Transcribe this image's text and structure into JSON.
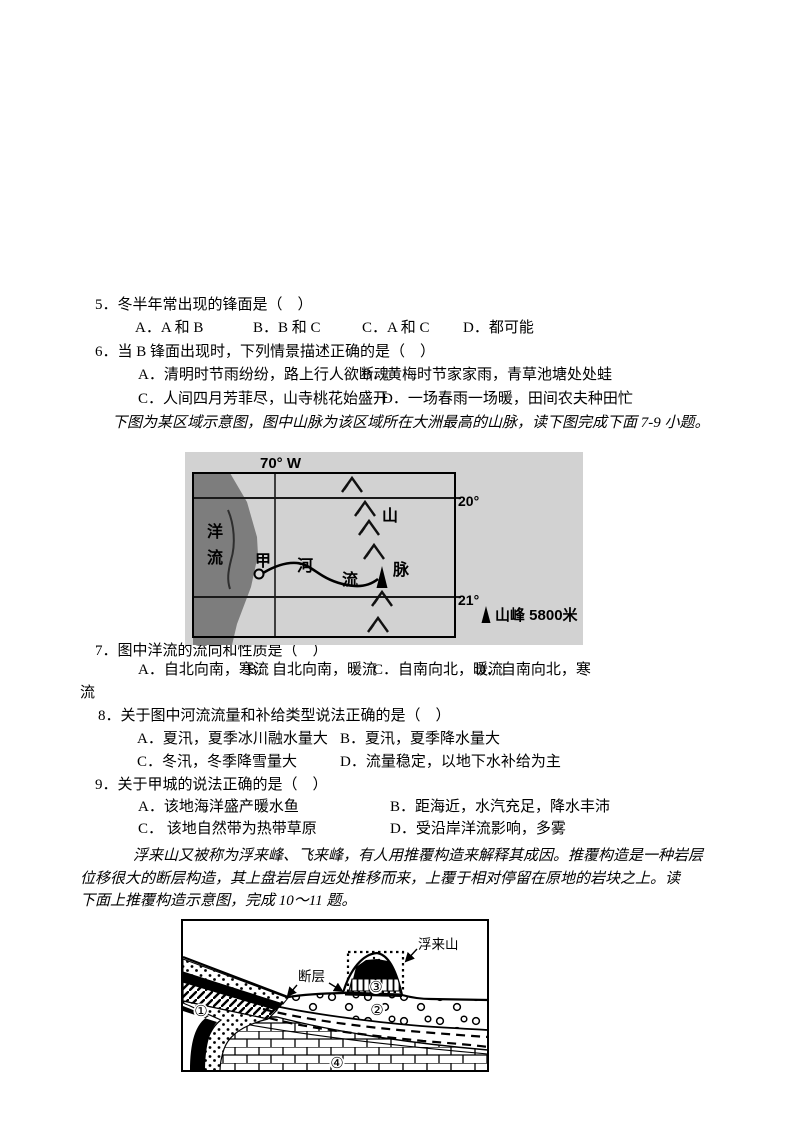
{
  "q5": {
    "stem": "5．冬半年常出现的锋面是（　）",
    "opt_a": "A．A 和 B",
    "opt_b": "B．B 和 C",
    "opt_c": "C．A 和 C",
    "opt_d": "D．都可能"
  },
  "q6": {
    "stem": "6．当 B 锋面出现时，下列情景描述正确的是（　）",
    "opt_a": "A．清明时节雨纷纷，路上行人欲断魂",
    "opt_b": "B．黄梅时节家家雨，青草池塘处处蛙",
    "opt_c": "C．人间四月芳菲尽，山寺桃花始盛开",
    "opt_d": "D．一场春雨一场暖，田间农夫种田忙"
  },
  "intro_7_9": "下图为某区域示意图，图中山脉为该区域所在大洲最高的山脉，读下图完成下面 7-9 小题。",
  "q7": {
    "stem": "7．图中洋流的流向和性质是（　）",
    "opt_a": "A．自北向南，寒流",
    "opt_b": "B．自北向南，暖流",
    "opt_c": "C．自南向北，暖流",
    "opt_d": "D．自南向北，寒",
    "wrap": "流"
  },
  "q8": {
    "stem": "8．关于图中河流流量和补给类型说法正确的是（　）",
    "opt_a": "A．夏汛，夏季冰川融水量大",
    "opt_b": "B．夏汛，夏季降水量大",
    "opt_c": "C．冬汛，冬季降雪量大",
    "opt_d": "D．流量稳定，以地下水补给为主"
  },
  "q9": {
    "stem": "9．关于甲城的说法正确的是（　）",
    "opt_a": "A．该地海洋盛产暖水鱼",
    "opt_b": "B．距海近，水汽充足，降水丰沛",
    "opt_c": "C． 该地自然带为热带草原",
    "opt_d": "D．受沿岸洋流影响，多雾"
  },
  "intro_10_11": {
    "line1": "浮来山又被称为浮来峰、飞来峰，有人用推覆构造来解释其成因。推覆构造是一种岩层",
    "line2": "位移很大的断层构造，其上盘岩层自远处推移而来，上覆于相对停留在原地的岩块之上。读",
    "line3": "下面上推覆构造示意图，完成 10～11 题。"
  },
  "map": {
    "longitude": "70° W",
    "lat_20": "20°",
    "lat_21": "21°",
    "ocean_current_1": "洋",
    "ocean_current_2": "流",
    "city": "甲",
    "river_1": "河",
    "river_2": "流",
    "range_1": "山",
    "range_2": "脉",
    "legend": "山峰  5800米",
    "colors": {
      "canvas": "#d2d2d2",
      "ocean": "#7d7d7d"
    }
  },
  "geo": {
    "fault": "断层",
    "mountain": "浮来山",
    "n1": "①",
    "n2": "②",
    "n3": "③",
    "n4": "④"
  }
}
